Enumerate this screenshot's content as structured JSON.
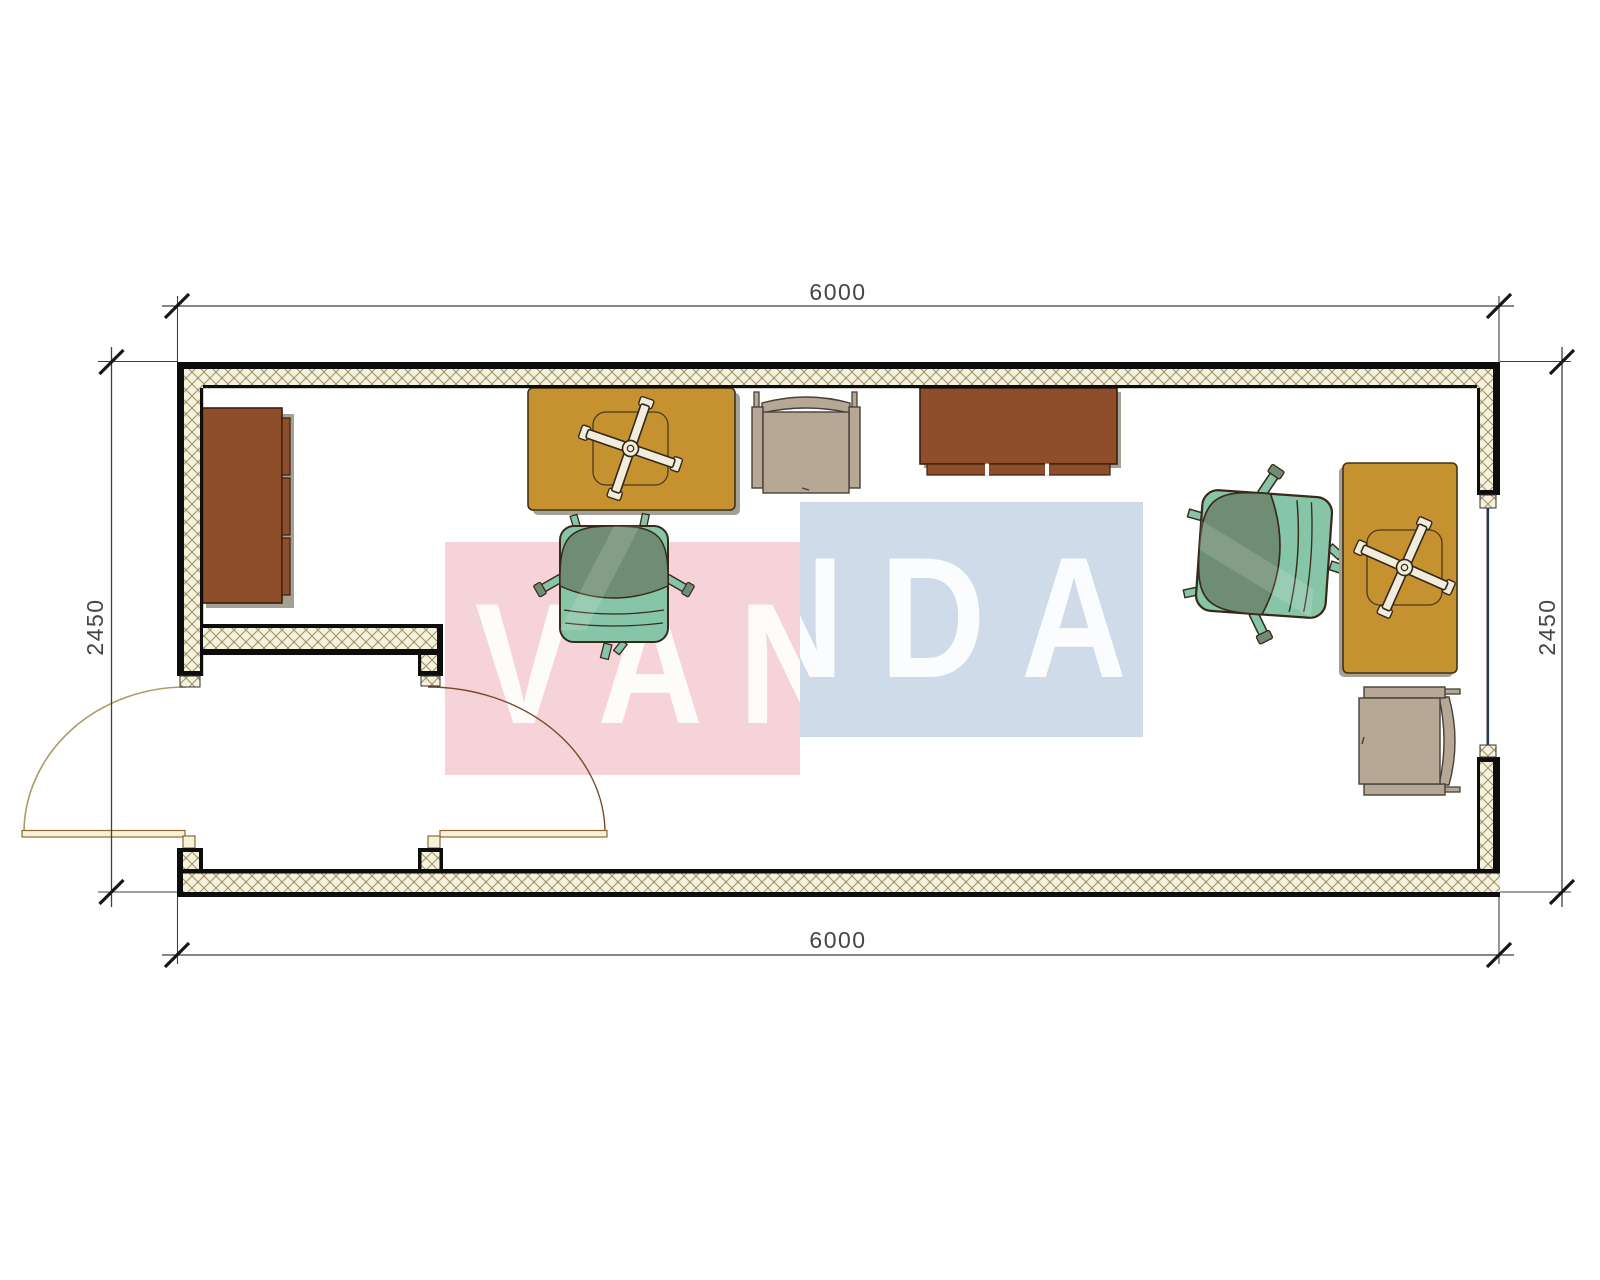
{
  "page": {
    "title": "Container office floor plan",
    "background": "#ffffff"
  },
  "dimensions": {
    "top": "6000",
    "bottom": "6000",
    "left": "2450",
    "right": "2450",
    "line_color": "#3f3f3f",
    "text_color": "#454545"
  },
  "watermark": {
    "word": "VANDA",
    "pink_block_color": "#f6d3d8",
    "blue_block_color": "#cfdbe9",
    "letter_color": "#ffffff"
  },
  "walls": {
    "outline_color": "#0d0d0d",
    "hatch_line_color": "#9a9160",
    "hatch_bg_color": "#f6f1df",
    "window_line_color": "#2c3752"
  },
  "door": {
    "leaf_color": "#f8f1da",
    "leaf_outline": "#8a6a30",
    "left_arc_color": "#b09a66",
    "right_arc_color": "#7a4a28"
  },
  "furniture": [
    {
      "name": "cabinet-left",
      "type": "sideboard",
      "color": "#8e4e2b"
    },
    {
      "name": "desk-top-left",
      "type": "desk-with-x-base",
      "color": "#c6922f"
    },
    {
      "name": "armchair-top-center",
      "type": "visitor-armchair",
      "color": "#b7a795"
    },
    {
      "name": "cabinet-top-center",
      "type": "sideboard",
      "color": "#8e4e2b"
    },
    {
      "name": "task-chair-left",
      "type": "office-chair",
      "color": "#87c5a8"
    },
    {
      "name": "task-chair-right",
      "type": "office-chair",
      "color": "#87c5a8"
    },
    {
      "name": "desk-right",
      "type": "desk-with-x-base",
      "color": "#c6922f"
    },
    {
      "name": "armchair-bottom-right",
      "type": "visitor-armchair",
      "color": "#b7a795"
    }
  ]
}
